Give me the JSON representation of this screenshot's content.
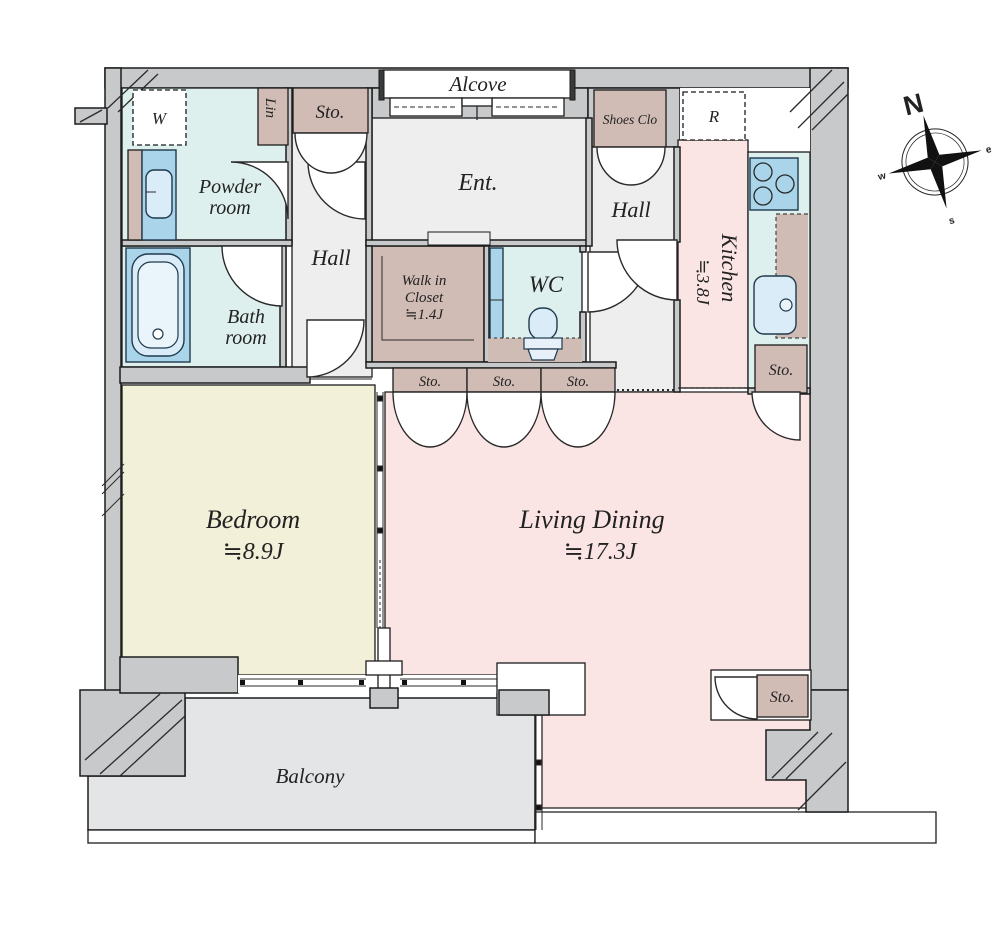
{
  "labels": {
    "alcove": "Alcove",
    "ent": "Ent.",
    "hall_left": "Hall",
    "hall_right": "Hall",
    "powder_line1": "Powder",
    "powder_line2": "room",
    "bath_line1": "Bath",
    "bath_line2": "room",
    "wc": "WC",
    "wic_line1": "Walk in",
    "wic_line2": "Closet",
    "wic_area": "≒1.4J",
    "kitchen": "Kitchen",
    "kitchen_area": "≒3.8J",
    "bedroom": "Bedroom",
    "bedroom_area": "≒8.9J",
    "living": "Living Dining",
    "living_area": "≒17.3J",
    "balcony": "Balcony",
    "shoes_closet": "Shoes Clo",
    "linen": "Lin",
    "washer": "W",
    "fridge": "R",
    "sto_top": "Sto.",
    "sto_a": "Sto.",
    "sto_b": "Sto.",
    "sto_c": "Sto.",
    "sto_kitchen": "Sto.",
    "sto_living": "Sto."
  },
  "compass": {
    "n": "N",
    "e": "e",
    "s": "s",
    "w": "w"
  },
  "colors": {
    "wall_gray": "#c7c9cb",
    "wet_room_cyan": "#def0ee",
    "fixture_blue": "#a9d4e9",
    "storage_taupe": "#d0bcb4",
    "living_pink": "#fbe5e4",
    "bedroom_cream": "#f3f0da",
    "hall_gray": "#eeeeef",
    "balcony_gray": "#e4e5e7",
    "line_black": "#1c1c1c"
  }
}
